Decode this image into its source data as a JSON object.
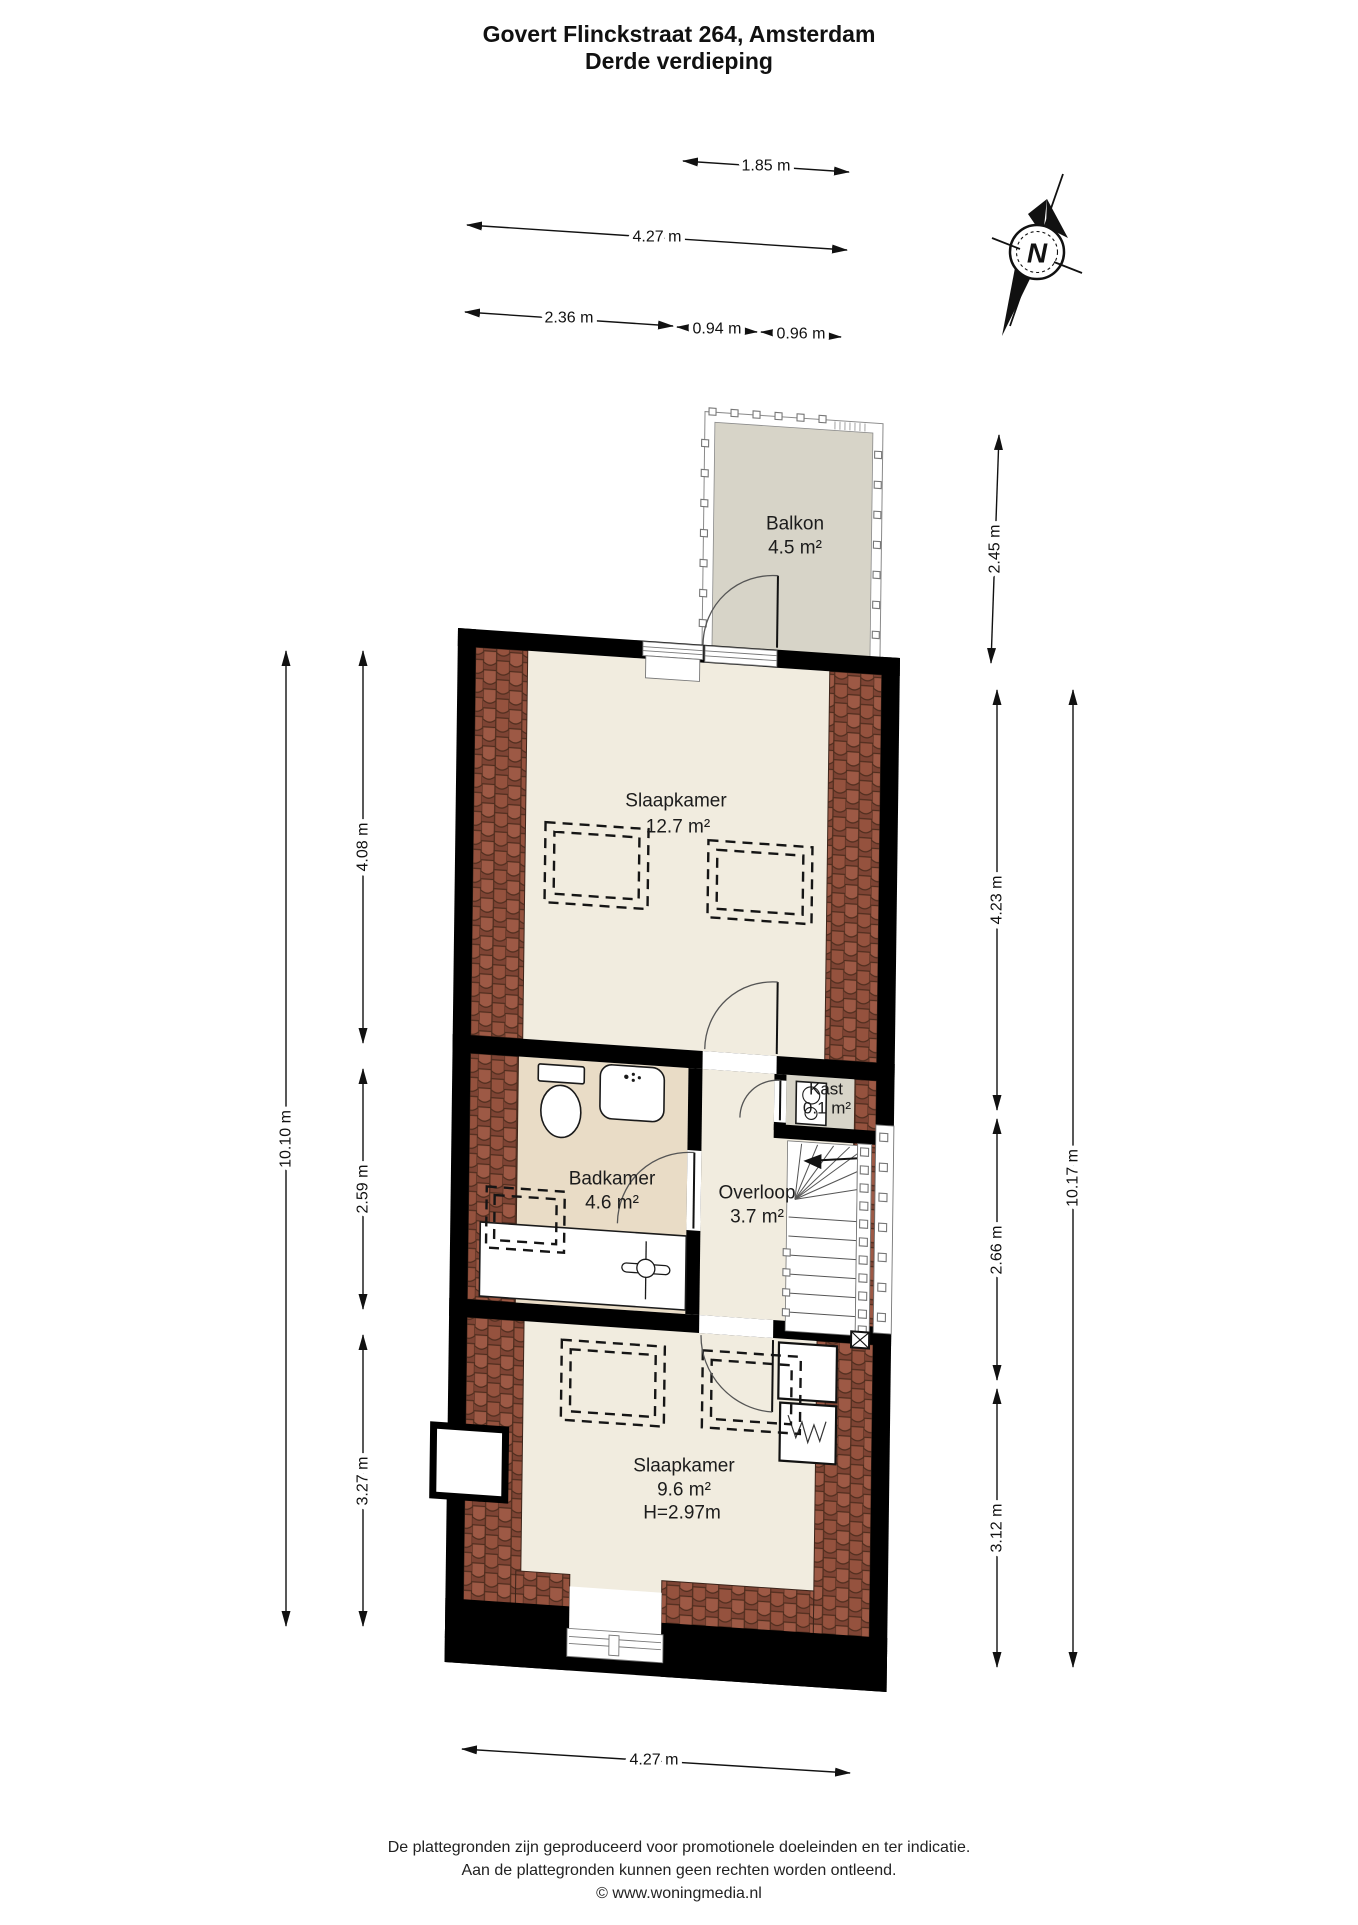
{
  "title": {
    "line1": "Govert Flinckstraat 264, Amsterdam",
    "line2": "Derde verdieping"
  },
  "compass": {
    "north_label": "N"
  },
  "rooms": {
    "balkon": {
      "name": "Balkon",
      "area": "4.5 m²"
    },
    "slaapkamer_boven": {
      "name": "Slaapkamer",
      "area": "12.7 m²"
    },
    "badkamer": {
      "name": "Badkamer",
      "area": "4.6 m²"
    },
    "overloop": {
      "name": "Overloop",
      "area": "3.7 m²"
    },
    "kast": {
      "name": "Kast",
      "area": "0.1 m²"
    },
    "slaapkamer_onder": {
      "name": "Slaapkamer",
      "area": "9.6 m²",
      "ceiling_height": "H=2.97m"
    }
  },
  "dimensions": {
    "top_balcony_width": "1.85 m",
    "top_total_width": "4.27 m",
    "top_badkamer_width": "2.36 m",
    "top_overloop_width": "0.94 m",
    "top_trap_width": "0.96 m",
    "left_total": "10.10 m",
    "left_seg1": "4.08 m",
    "left_seg2": "2.59 m",
    "left_seg3": "3.27 m",
    "right_balcony_depth": "2.45 m",
    "right_seg1": "4.23 m",
    "right_seg2": "2.66 m",
    "right_seg3": "3.12 m",
    "right_total": "10.17 m",
    "bottom_width": "4.27 m"
  },
  "footer": {
    "line1": "De plattegronden zijn geproduceerd voor promotionele doeleinden en ter indicatie.",
    "line2": "Aan de plattegronden kunnen geen rechten worden ontleend.",
    "line3": "© www.woningmedia.nl"
  },
  "colors": {
    "wall": "#000000",
    "floor_cream": "#f1ecdf",
    "bathroom_floor": "#e9dcc6",
    "balcony_floor": "#d7d4c8",
    "closet_floor": "#d7d4c8",
    "roof_tiles": "#9a5945",
    "dimension_text": "#111111"
  }
}
